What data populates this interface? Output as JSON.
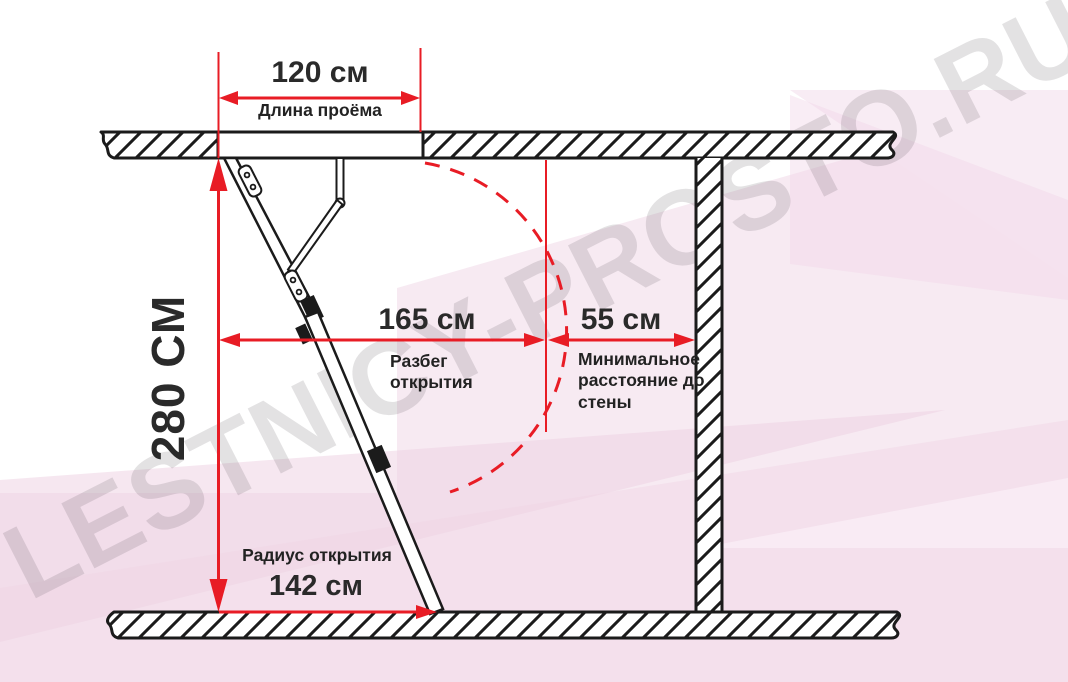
{
  "diagram": {
    "type": "attic-ladder-installation-dimensions",
    "watermark": "LESTNICY-PROSTO.RU",
    "dimensions": {
      "opening_length": {
        "value": "120 см",
        "label": "Длина проёма"
      },
      "ceiling_height": {
        "value": "280 СМ"
      },
      "opening_span": {
        "value": "165 см",
        "label": "Разбег открытия"
      },
      "wall_distance": {
        "value": "55 см",
        "label": "Минимальное расстояние до стены"
      },
      "opening_radius": {
        "value": "142 см",
        "label": "Радиус открытия"
      }
    },
    "colors": {
      "dimension_red": "#e81c25",
      "line_black": "#1b1b1b",
      "text_dark": "#262626",
      "background_pink": "#f7eaf2"
    }
  }
}
